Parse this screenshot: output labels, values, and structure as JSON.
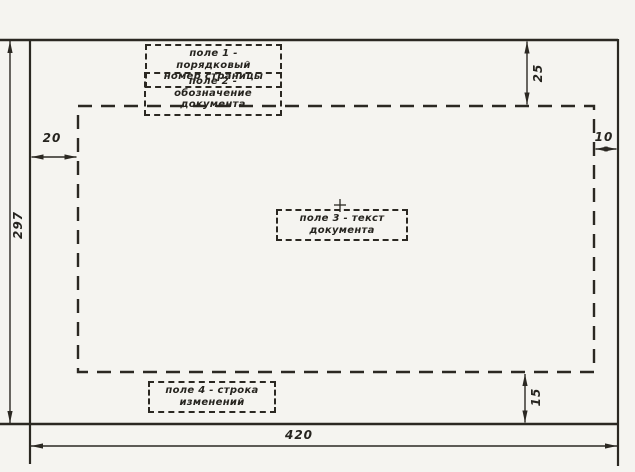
{
  "drawing": {
    "labels": {
      "field1": "поле 1 - порядковый\nномер страницы",
      "field2": "поле 2 - обозначение\nдокумента",
      "field3": "поле 3 - текст\nдокумента",
      "field4": "поле 4 - строка\nизменений"
    },
    "dimensions": {
      "page_height": "297",
      "page_width": "420",
      "top_margin": "25",
      "left_margin": "20",
      "right_margin": "10",
      "bottom_margin": "15"
    },
    "colors": {
      "ink": "#2b2822",
      "paper": "#f5f4f0"
    }
  }
}
